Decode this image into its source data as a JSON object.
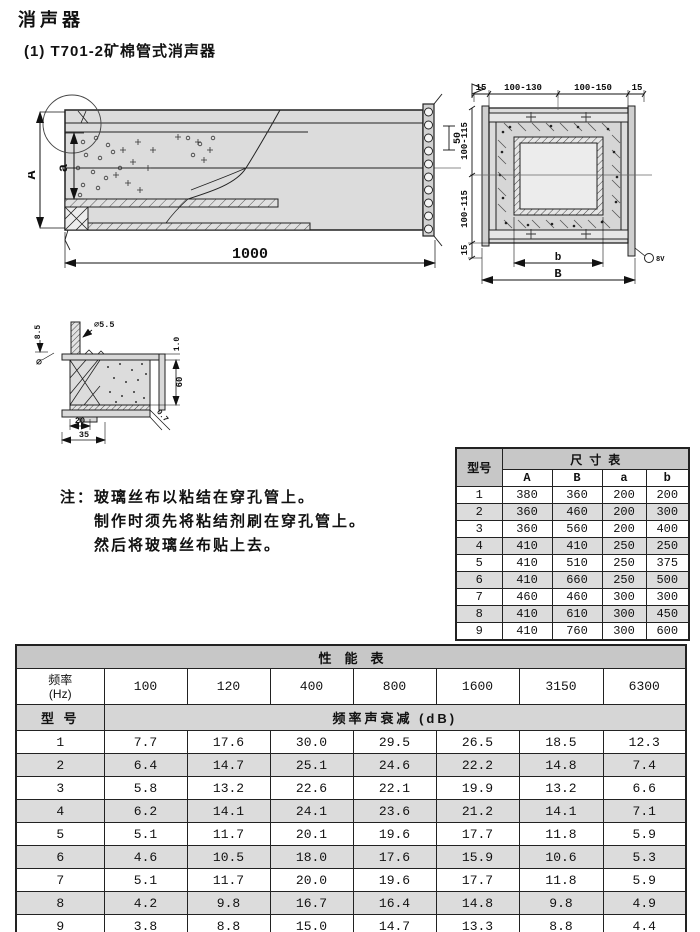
{
  "page": {
    "title": "消声器",
    "subtitle": "(1) T701-2矿棉管式消声器"
  },
  "drawings": {
    "side_view": {
      "length": "1000",
      "height_outer": "A",
      "height_inner": "a",
      "flange_pitch": "50"
    },
    "cross_section": {
      "top_dims": [
        "15",
        "100-130",
        "100-150",
        "15"
      ],
      "left_dims": [
        "100-115",
        "100-115",
        "15"
      ],
      "inner_width": "b",
      "outer_width": "B",
      "stud_label": "8V"
    },
    "detail": {
      "rivet_height": "8.5",
      "diameter_symbol": "∅",
      "hole_dia": "∅5.5",
      "sheet_thk": "1.0",
      "liner_height": "60",
      "cloth_thk": "0.7",
      "foot_width": "20",
      "base_width": "35"
    }
  },
  "note": {
    "label": "注：",
    "line1": "玻璃丝布以粘结在穿孔管上。",
    "line2": "制作时须先将粘结剂刷在穿孔管上。",
    "line3": "然后将玻璃丝布贴上去。"
  },
  "dim_table": {
    "title": "尺寸表",
    "model_header": "型号",
    "columns": [
      "A",
      "B",
      "a",
      "b"
    ],
    "rows": [
      {
        "model": "1",
        "values": [
          "380",
          "360",
          "200",
          "200"
        ]
      },
      {
        "model": "2",
        "values": [
          "360",
          "460",
          "200",
          "300"
        ]
      },
      {
        "model": "3",
        "values": [
          "360",
          "560",
          "200",
          "400"
        ]
      },
      {
        "model": "4",
        "values": [
          "410",
          "410",
          "250",
          "250"
        ]
      },
      {
        "model": "5",
        "values": [
          "410",
          "510",
          "250",
          "375"
        ]
      },
      {
        "model": "6",
        "values": [
          "410",
          "660",
          "250",
          "500"
        ]
      },
      {
        "model": "7",
        "values": [
          "460",
          "460",
          "300",
          "300"
        ]
      },
      {
        "model": "8",
        "values": [
          "410",
          "610",
          "300",
          "450"
        ]
      },
      {
        "model": "9",
        "values": [
          "410",
          "760",
          "300",
          "600"
        ]
      }
    ]
  },
  "perf_table": {
    "title": "性能表",
    "freq_label": "频率",
    "freq_unit": "(Hz)",
    "frequencies": [
      "100",
      "120",
      "400",
      "800",
      "1600",
      "3150",
      "6300"
    ],
    "model_header": "型 号",
    "attenuation_header": "频率声衰减 (dB)",
    "rows": [
      {
        "model": "1",
        "values": [
          "7.7",
          "17.6",
          "30.0",
          "29.5",
          "26.5",
          "18.5",
          "12.3"
        ]
      },
      {
        "model": "2",
        "values": [
          "6.4",
          "14.7",
          "25.1",
          "24.6",
          "22.2",
          "14.8",
          "7.4"
        ]
      },
      {
        "model": "3",
        "values": [
          "5.8",
          "13.2",
          "22.6",
          "22.1",
          "19.9",
          "13.2",
          "6.6"
        ]
      },
      {
        "model": "4",
        "values": [
          "6.2",
          "14.1",
          "24.1",
          "23.6",
          "21.2",
          "14.1",
          "7.1"
        ]
      },
      {
        "model": "5",
        "values": [
          "5.1",
          "11.7",
          "20.1",
          "19.6",
          "17.7",
          "11.8",
          "5.9"
        ]
      },
      {
        "model": "6",
        "values": [
          "4.6",
          "10.5",
          "18.0",
          "17.6",
          "15.9",
          "10.6",
          "5.3"
        ]
      },
      {
        "model": "7",
        "values": [
          "5.1",
          "11.7",
          "20.0",
          "19.6",
          "17.7",
          "11.8",
          "5.9"
        ]
      },
      {
        "model": "8",
        "values": [
          "4.2",
          "9.8",
          "16.7",
          "16.4",
          "14.8",
          "9.8",
          "4.9"
        ]
      },
      {
        "model": "9",
        "values": [
          "3.8",
          "8.8",
          "15.0",
          "14.7",
          "13.3",
          "8.8",
          "4.4"
        ]
      }
    ]
  },
  "colors": {
    "table_header_bg": "#c7c7c7",
    "row_alt_bg": "#dcdcdc",
    "drawing_fill": "#dcdcdc",
    "line": "#222222"
  }
}
